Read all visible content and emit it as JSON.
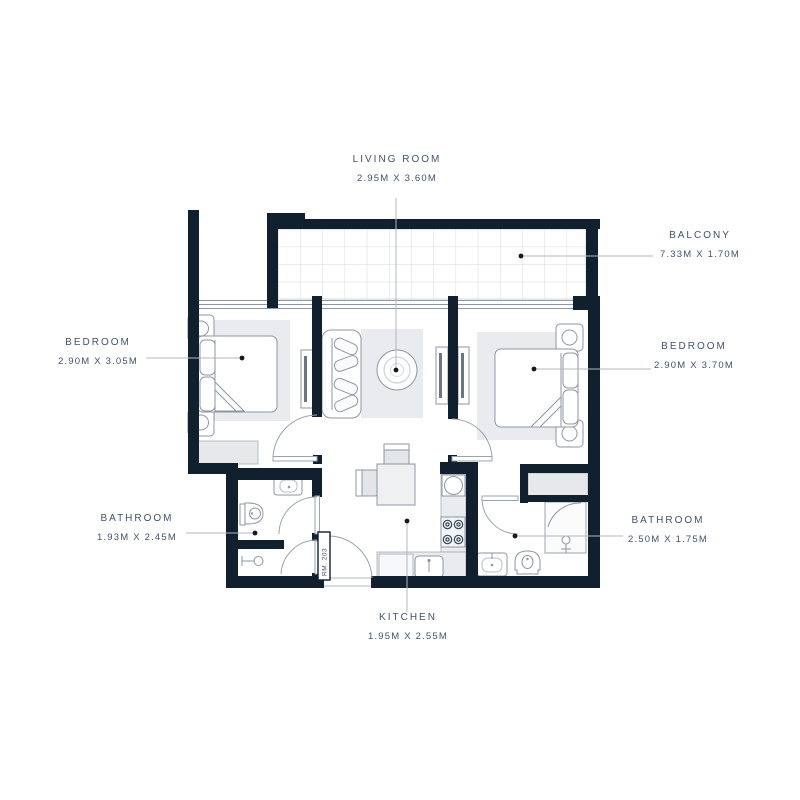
{
  "plan": {
    "title": "Apartment floor plan",
    "unit_label": "RM. 203",
    "rooms": [
      {
        "id": "living_room",
        "name": "LIVING ROOM",
        "dims": "2.95M X 3.60M"
      },
      {
        "id": "balcony",
        "name": "BALCONY",
        "dims": "7.33M X 1.70M"
      },
      {
        "id": "bedroom_left",
        "name": "BEDROOM",
        "dims": "2.90M X 3.05M"
      },
      {
        "id": "bedroom_right",
        "name": "BEDROOM",
        "dims": "2.90M X 3.70M"
      },
      {
        "id": "bathroom_left",
        "name": "BATHROOM",
        "dims": "1.93M X 2.45M"
      },
      {
        "id": "bathroom_right",
        "name": "BATHROOM",
        "dims": "2.50M X 1.75M"
      },
      {
        "id": "kitchen",
        "name": "KITCHEN",
        "dims": "1.95M X 2.55M"
      }
    ],
    "colors": {
      "walls": "#10202e",
      "label_text": "#42526d",
      "furniture_lines": "#8d97a3",
      "light_fill": "#e9ebee",
      "leader_line": "#b0b8c0",
      "leader_dot": "#16181a",
      "tile_grid": "#d4d8dd"
    }
  }
}
